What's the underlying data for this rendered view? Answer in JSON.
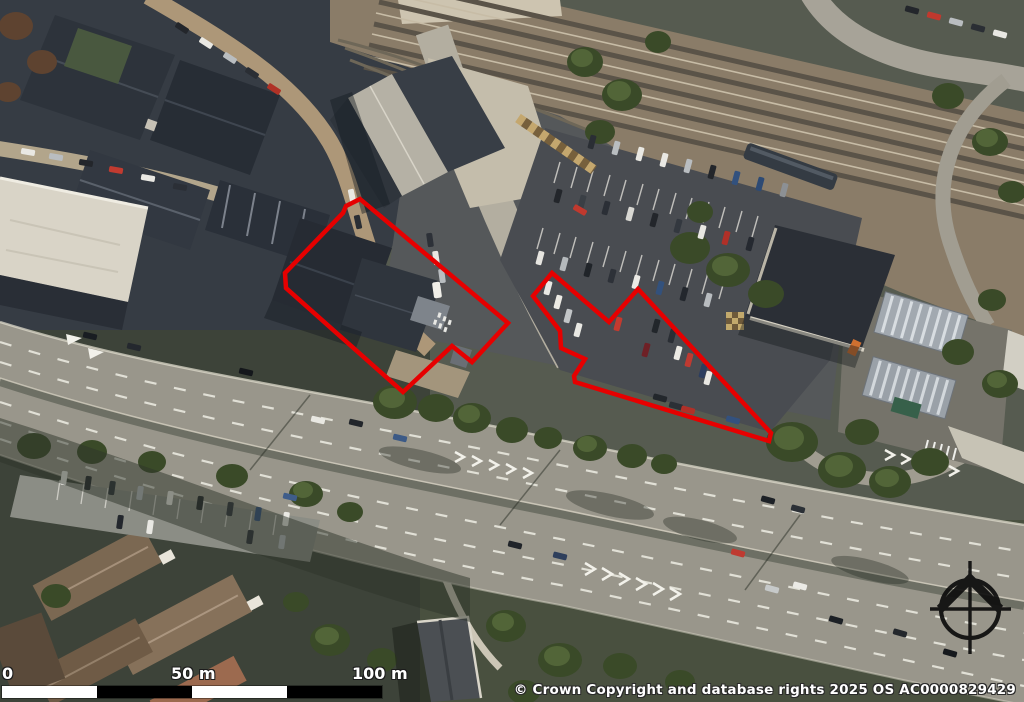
{
  "map": {
    "type": "aerial-photo",
    "boundary_color": "#e60000",
    "site_outlines": [
      {
        "name": "main-building-site",
        "points": "360,199 346,206 343,213 285,273 286,288 403,392 452,346 472,362 508,323"
      },
      {
        "name": "car-park-site",
        "points": "533,296 560,331 561,348 585,359 574,376 575,382 769,441 771,433 638,289 609,322 552,273"
      }
    ]
  },
  "scale_bar": {
    "labels": [
      {
        "text": "0"
      },
      {
        "text": "50 m"
      },
      {
        "text": "100 m"
      }
    ],
    "segment_colors": [
      "#ffffff",
      "#000000",
      "#ffffff",
      "#000000"
    ]
  },
  "copyright": "© Crown Copyright and database rights 2025 OS AC0000829429",
  "compass": {
    "type": "north-arrow",
    "color": "#0d0d0d"
  }
}
